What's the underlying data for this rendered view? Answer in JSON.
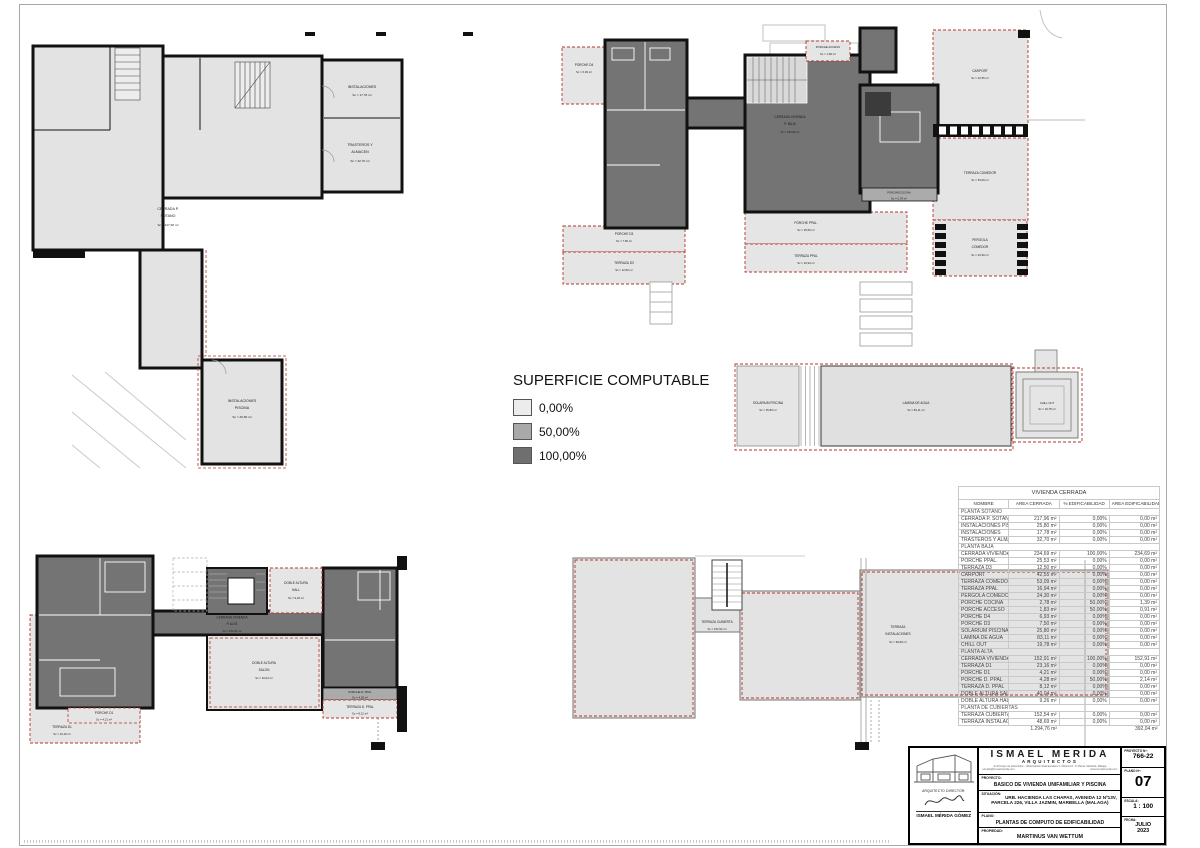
{
  "legend": {
    "title": "SUPERFICIE COMPUTABLE",
    "items": [
      {
        "label": "0,00%"
      },
      {
        "label": "50,00%"
      },
      {
        "label": "100,00%"
      }
    ]
  },
  "colors": {
    "pct_0": "#ececec",
    "pct_50": "#a9a9a9",
    "pct_100": "#6f6f6f",
    "dashed_boundary_red": "#b4362a",
    "wall_black": "#111111"
  },
  "plans": {
    "sotano": {
      "rooms": {
        "cerrada": {
          "l1": "CERRADA P.",
          "l2": "SOTANO",
          "area": "Sc = 217,96 m²"
        },
        "instalaciones": {
          "l1": "INSTALACIONES",
          "area": "Sc = 17,78 m²"
        },
        "trasteros": {
          "l1": "TRASTEROS Y",
          "l2": "ALMACEN",
          "area": "Sc = 32,70 m²"
        },
        "inst_piscina": {
          "l1": "INSTALACIONES",
          "l2": "PISCINA",
          "area": "Sc = 25,80 m²"
        }
      }
    },
    "baja": {
      "rooms": {
        "porche_d4": {
          "l1": "PORCHE D4",
          "area": "Sc = 6,93 m²"
        },
        "porche_acceso": {
          "l1": "PORCHE ACCESO",
          "area": "Sc = 1,83 m²"
        },
        "cerrada": {
          "l1": "CERRADA VIVIENDA",
          "l2": "P. BAJA",
          "area": "Sc = 234,69 m²"
        },
        "carport": {
          "l1": "CARPORT",
          "area": "Sc = 42,55 m²"
        },
        "terraza_comedor": {
          "l1": "TERRAZA COMEDOR",
          "area": "Sc = 53,09 m²"
        },
        "porche_cocina": {
          "l1": "PORCHE/COCINA",
          "area": "Sc = 2,78 m²"
        },
        "pergola": {
          "l1": "PERGOLA",
          "l2": "COMEDOR",
          "area": "Sc = 24,30 m²"
        },
        "porche_d3": {
          "l1": "PORCHE D3",
          "area": "Sc = 7,50 m²"
        },
        "terraza_d3": {
          "l1": "TERRAZA D3",
          "area": "Sc = 12,50 m²"
        },
        "porche_ppal": {
          "l1": "PORCHE PPAL.",
          "area": "Sc = 25,53 m²"
        },
        "terraza_ppal": {
          "l1": "TERRAZA PPAL",
          "area": "Sc = 16,94 m²"
        },
        "solarium": {
          "l1": "SOLARIUM PISCINA",
          "area": "Sc = 25,80 m²"
        },
        "lamina": {
          "l1": "LAMINA DE AGUA",
          "area": "Sc = 83,11 m²"
        },
        "chill": {
          "l1": "CHILL OUT",
          "area": "Sc = 19,78 m²"
        }
      }
    },
    "alta": {
      "rooms": {
        "hall": {
          "l1": "DOBLE ALTURA",
          "l2": "HALL",
          "area": "Sc = 9,26 m²"
        },
        "cerrada": {
          "l1": "CERRADA VIVIENDA",
          "l2": "P. ALTA",
          "area": "Sc = 152,91 m²"
        },
        "salon": {
          "l1": "DOBLE ALTURA",
          "l2": "SALON",
          "area": "Sc = 40,04 m²"
        },
        "porche_dppal": {
          "l1": "PORCHE D. PPAL",
          "area": "Sc = 4,28 m²"
        },
        "terraza_dppal": {
          "l1": "TERRAZA D. PPAL",
          "area": "Sc = 8,12 m²"
        },
        "porche_d1": {
          "l1": "PORCHE D1",
          "area": "Sc = 4,21 m²"
        },
        "terraza_d1": {
          "l1": "TERRAZA D1",
          "area": "Sc = 23,16 m²"
        }
      }
    },
    "cubiertas": {
      "rooms": {
        "terraza_cubierta": {
          "l1": "TERRAZA CUBIERTA",
          "area": "Sc = 152,54 m²"
        },
        "terraza_inst": {
          "l1": "TERRAZA",
          "l2": "INSTALACIONES",
          "area": "Sc = 48,69 m²"
        }
      }
    }
  },
  "table": {
    "title": "VIVIENDA CERRADA",
    "columns": [
      "NOMBRE",
      "AREA CERRADA",
      "% EDIFICABILIDAD",
      "AREA EDIFICABILIDAD"
    ],
    "sections": [
      {
        "name": "PLANTA SOTANO",
        "rows": [
          {
            "name": "CERRADA P. SOTANO",
            "area": "217,96 m²",
            "pct": "0,00%",
            "edif": "0,00 m²"
          },
          {
            "name": "INSTALACIONES PISCINA",
            "area": "25,80 m²",
            "pct": "0,00%",
            "edif": "0,00 m²"
          },
          {
            "name": "INSTALACIONES",
            "area": "17,78 m²",
            "pct": "0,00%",
            "edif": "0,00 m²"
          },
          {
            "name": "TRASTEROS Y ALMACEN",
            "area": "32,70 m²",
            "pct": "0,00%",
            "edif": "0,00 m²"
          }
        ]
      },
      {
        "name": "PLANTA BAJA",
        "rows": [
          {
            "name": "CERRADA VIVIENDA P. BAJA",
            "area": "234,69 m²",
            "pct": "100,00%",
            "edif": "234,69 m²"
          },
          {
            "name": "PORCHE PPAL.",
            "area": "25,53 m²",
            "pct": "0,00%",
            "edif": "0,00 m²"
          },
          {
            "name": "TERRAZA D3",
            "area": "12,50 m²",
            "pct": "0,00%",
            "edif": "0,00 m²"
          },
          {
            "name": "CARPORT",
            "area": "42,55 m²",
            "pct": "0,00%",
            "edif": "0,00 m²"
          },
          {
            "name": "TERRAZA COMEDOR",
            "area": "53,09 m²",
            "pct": "0,00%",
            "edif": "0,00 m²"
          },
          {
            "name": "TERRAZA PPAL",
            "area": "16,94 m²",
            "pct": "0,00%",
            "edif": "0,00 m²"
          },
          {
            "name": "PERGOLA COMEDOR",
            "area": "24,30 m²",
            "pct": "0,00%",
            "edif": "0,00 m²"
          },
          {
            "name": "PORCHE COCINA",
            "area": "2,78 m²",
            "pct": "50,00%",
            "edif": "1,39 m²"
          },
          {
            "name": "PORCHE ACCESO",
            "area": "1,83 m²",
            "pct": "50,00%",
            "edif": "0,91 m²"
          },
          {
            "name": "PORCHE D4",
            "area": "6,93 m²",
            "pct": "0,00%",
            "edif": "0,00 m²"
          },
          {
            "name": "PORCHE D3",
            "area": "7,50 m²",
            "pct": "0,00%",
            "edif": "0,00 m²"
          },
          {
            "name": "SOLARIUM PISCINA",
            "area": "25,80 m²",
            "pct": "0,00%",
            "edif": "0,00 m²"
          },
          {
            "name": "LAMINA DE AGUA",
            "area": "83,11 m²",
            "pct": "0,00%",
            "edif": "0,00 m²"
          },
          {
            "name": "CHILL OUT",
            "area": "19,78 m²",
            "pct": "0,00%",
            "edif": "0,00 m²"
          }
        ]
      },
      {
        "name": "PLANTA ALTA",
        "rows": [
          {
            "name": "CERRADA VIVIENDA P. ALTA",
            "area": "152,91 m²",
            "pct": "100,00%",
            "edif": "152,91 m²"
          },
          {
            "name": "TERRAZA D1",
            "area": "23,16 m²",
            "pct": "0,00%",
            "edif": "0,00 m²"
          },
          {
            "name": "PORCHE D1",
            "area": "4,21 m²",
            "pct": "0,00%",
            "edif": "0,00 m²"
          },
          {
            "name": "PORCHE D. PPAL",
            "area": "4,28 m²",
            "pct": "50,00%",
            "edif": "2,14 m²"
          },
          {
            "name": "TERRAZA D. PPAL",
            "area": "8,12 m²",
            "pct": "0,00%",
            "edif": "0,00 m²"
          },
          {
            "name": "DOBLE ALTURA SALON",
            "area": "40,04 m²",
            "pct": "0,00%",
            "edif": "0,00 m²"
          },
          {
            "name": "DOBLE ALTURA HALL",
            "area": "9,26 m²",
            "pct": "0,00%",
            "edif": "0,00 m²"
          }
        ]
      },
      {
        "name": "PLANTA DE CUBIERTAS",
        "rows": [
          {
            "name": "TERRAZA CUBIERTA",
            "area": "152,54 m²",
            "pct": "0,00%",
            "edif": "0,00 m²"
          },
          {
            "name": "TERRAZA INSTALACIONES",
            "area": "48,69 m²",
            "pct": "0,00%",
            "edif": "0,00 m²"
          }
        ]
      }
    ],
    "total": {
      "area": "1.294,76 m²",
      "edif": "392,04 m²"
    }
  },
  "titleblock": {
    "architect_label": "ARQUITECTO DIRECTOR:",
    "architect_name": "ISMAEL MÉRIDA GÓMEZ",
    "firm": "ISMAEL MERIDA",
    "firm_sub": "ARQUITECTOS",
    "address": "Av.Príncipe de Hohenlohe - Urbanización Real Escalera 3. Oficina 10. 1ª Planta. Marbella. Málaga",
    "email": "estudio@ismaelmerida.com",
    "web": "www.ismaelmerida.com",
    "proyecto_label": "PROYECTO:",
    "proyecto": "BASICO DE VIVIENDA UNIFAMILIAR Y PISCINA",
    "situacion_label": "SITUACIÓN:",
    "situacion1": "URB. HACIENDA LAS CHAPAS, AVENIDA 12 Nº13V,",
    "situacion2": "PARCELA 226, VILLA JAZMIN, MARBELLA (MALAGA)",
    "plano_label": "PLANO:",
    "plano": "PLANTAS DE COMPUTO DE EDIFICABILIDAD",
    "propiedad_label": "PROPIEDAD:",
    "propiedad": "MARTINUS VAN WETTUM",
    "proyecto_num_label": "PROYECTO Nº:",
    "proyecto_num": "766-22",
    "plano_num_label": "PLANO Nº:",
    "plano_num": "07",
    "escala_label": "ESCALA:",
    "escala": "1 : 100",
    "fecha_label": "FECHA:",
    "fecha1": "JULIO",
    "fecha2": "2023"
  }
}
